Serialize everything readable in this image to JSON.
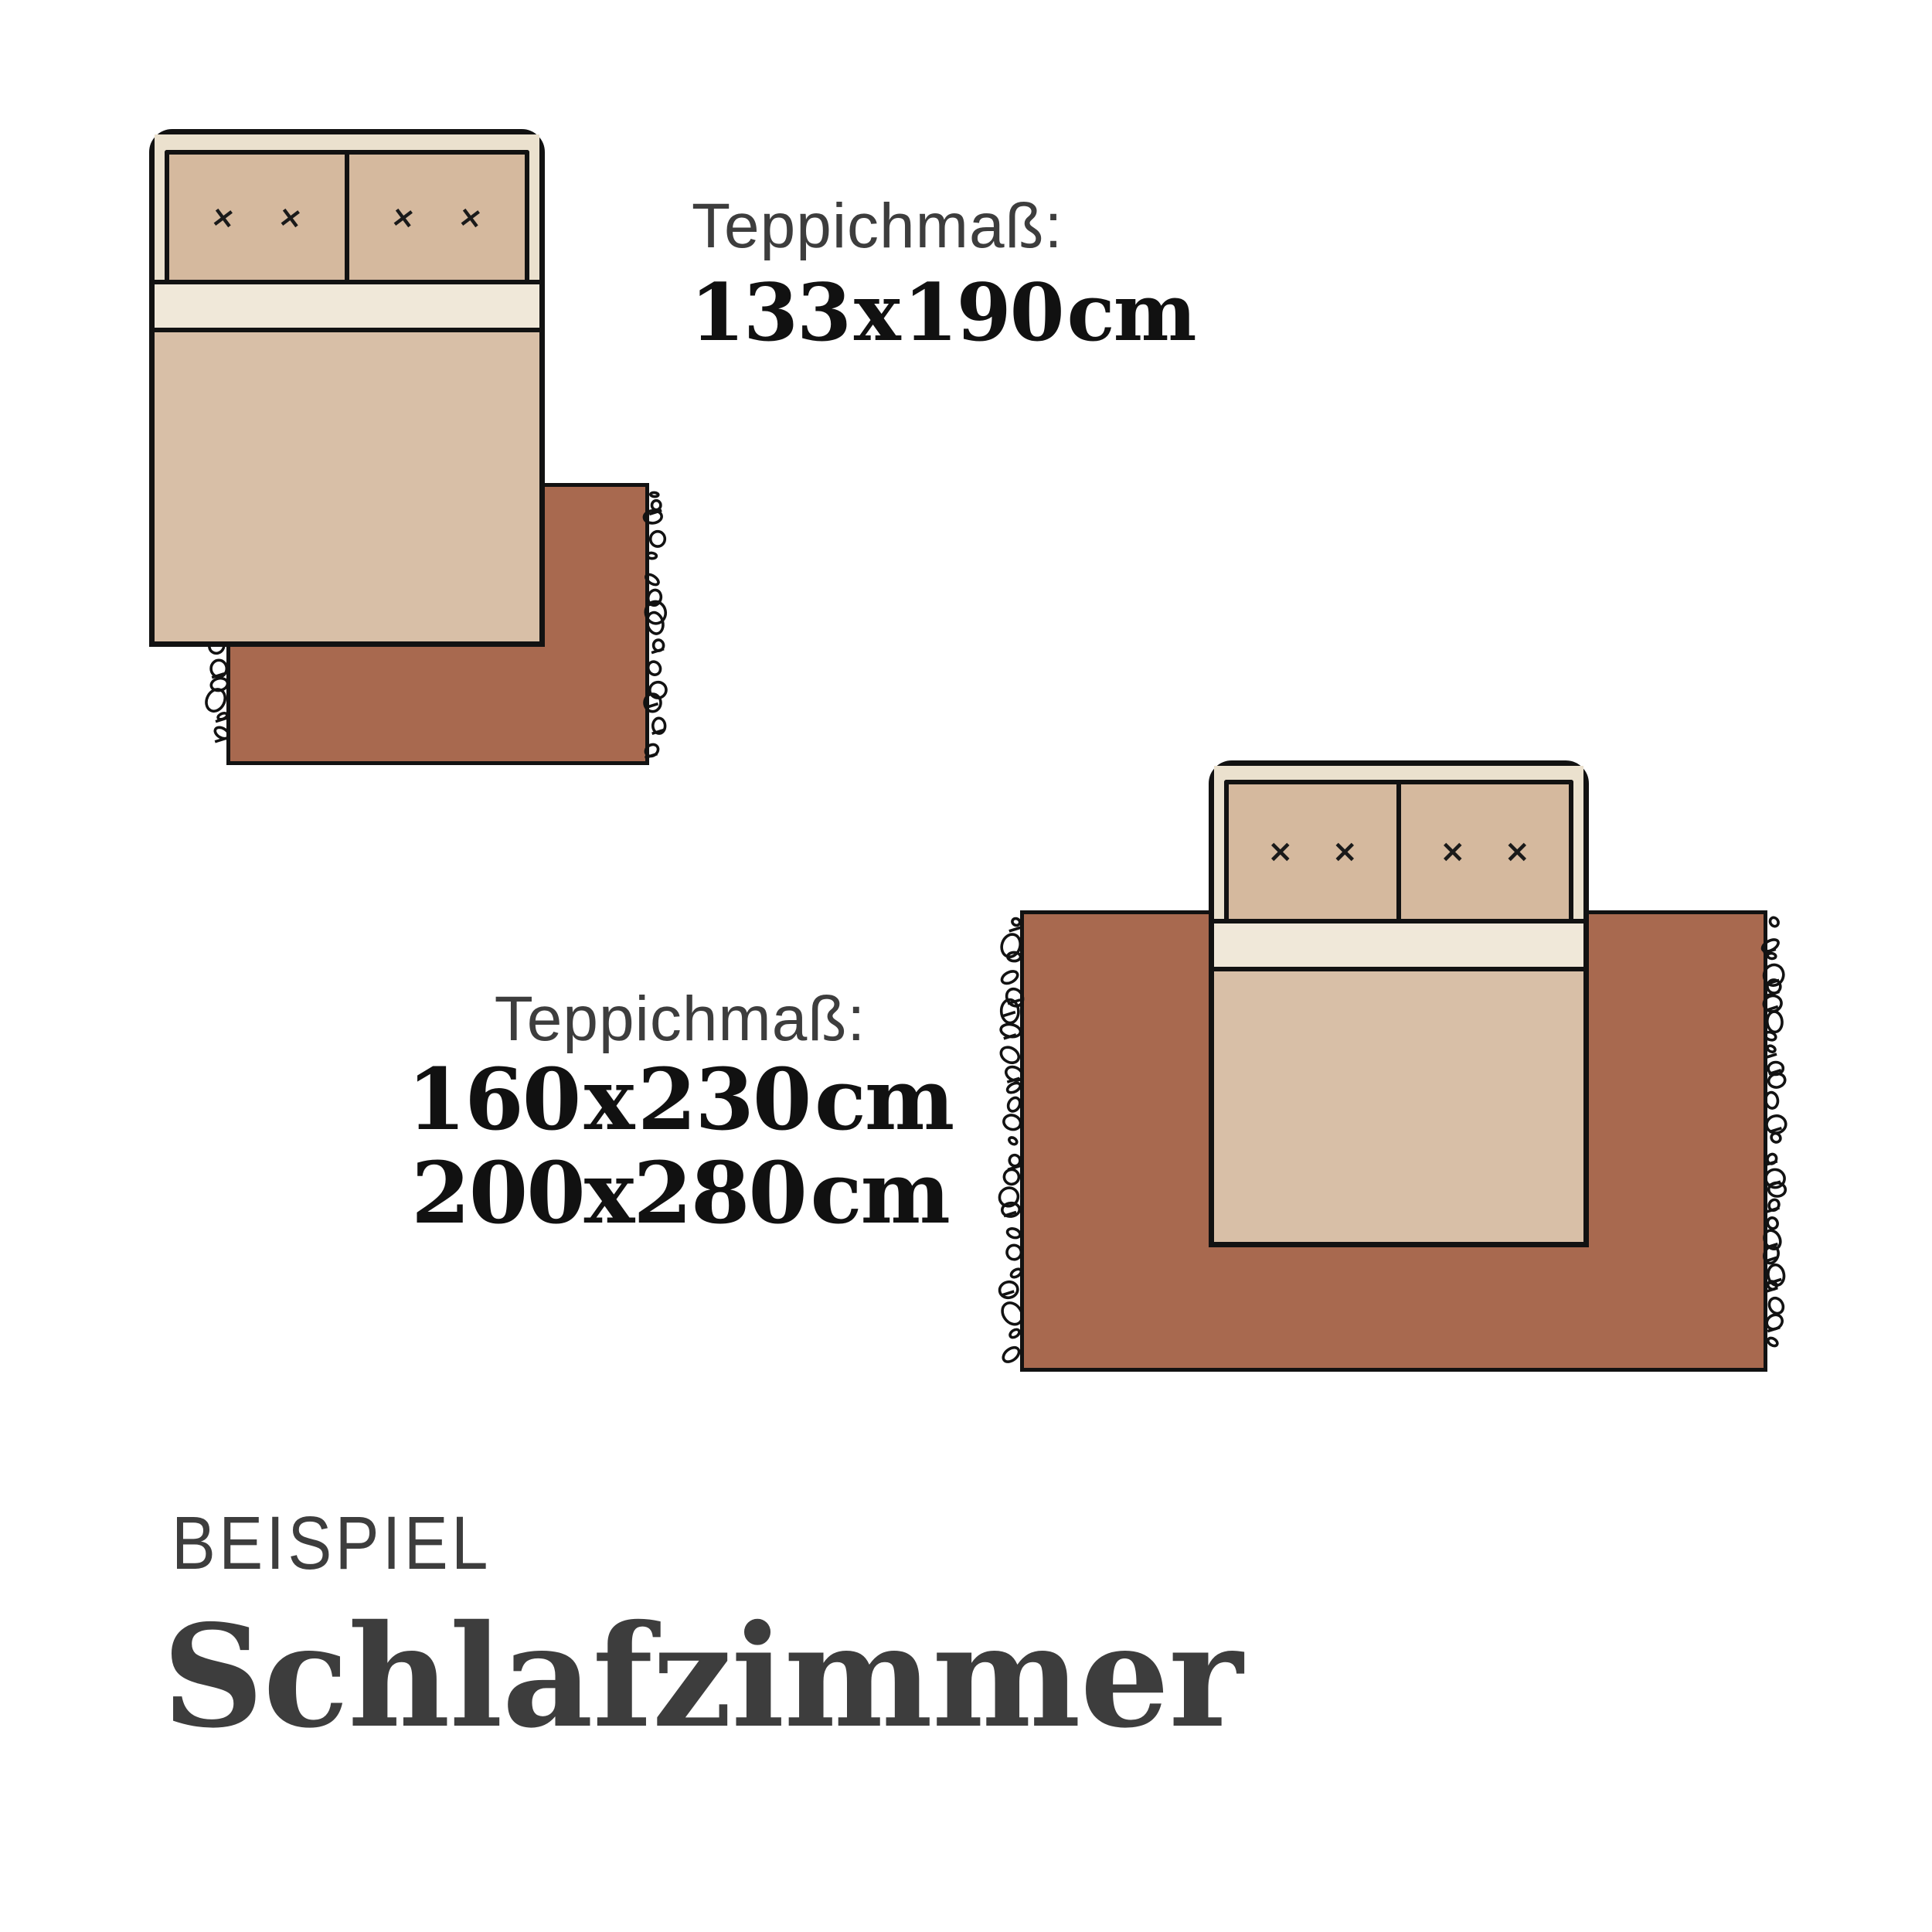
{
  "pillow_mark": "×",
  "section1": {
    "label": "Teppichmaß:",
    "size": "133 x 190 cm"
  },
  "section2": {
    "label": "Teppichmaß:",
    "sizes": [
      "160 x 230 cm",
      "200x280 cm"
    ]
  },
  "footer": {
    "kicker": "BEISPIEL",
    "title": "Schlafzimmer"
  },
  "colors": {
    "rug": "#a8694f",
    "outline": "#121212",
    "bed_frame": "#ebe1ce",
    "sheet": "#f0e8d9",
    "blanket": "#d8bfa7",
    "pillow": "#d5b99e",
    "label_gray": "#3d3d3d",
    "size_black": "#111111",
    "background": "#ffffff"
  }
}
